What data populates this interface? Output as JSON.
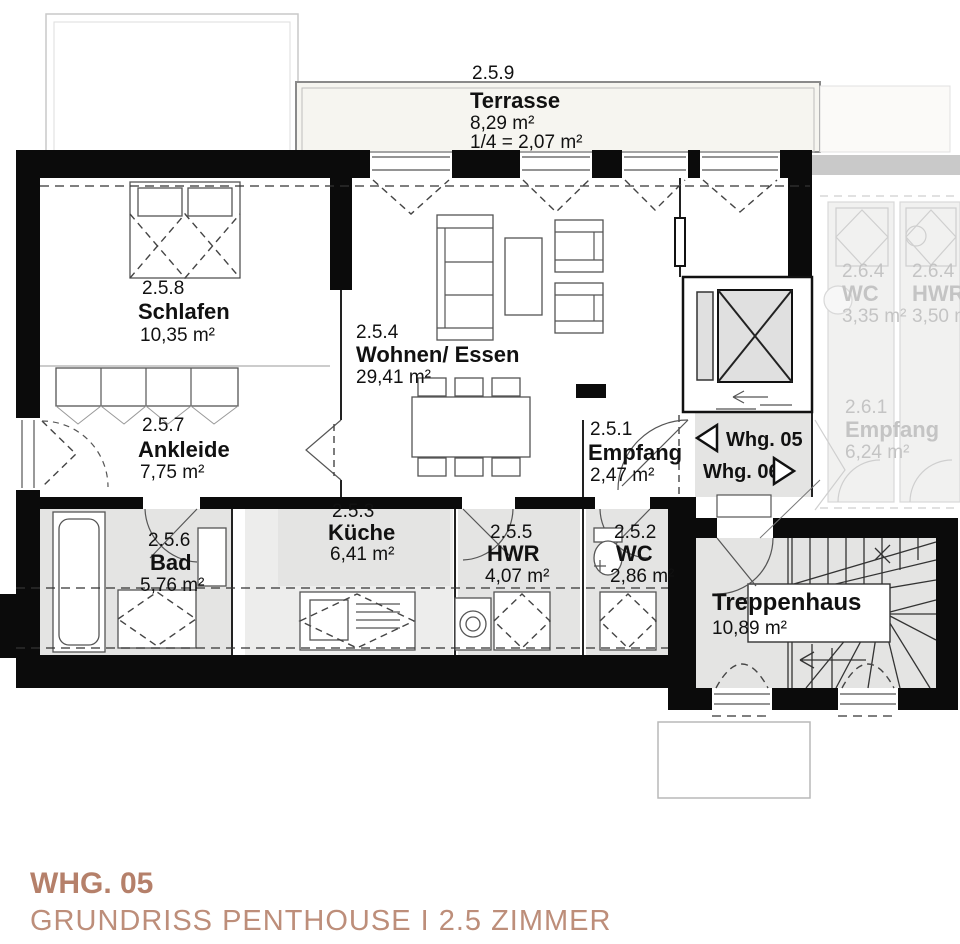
{
  "colors": {
    "wall": "#0b0b0b",
    "room_floor_gray": "#e4e4e3",
    "terrace_fill": "#f6f5f0",
    "neighbor_text": "#c4c4c4",
    "accent_title": "#b5806a",
    "accent_subtitle": "#bd8e7a"
  },
  "terrace": {
    "number": "2.5.9",
    "name": "Terrasse",
    "area": "8,29 m²",
    "share": "1/4 = 2,07 m²"
  },
  "rooms": [
    {
      "number": "2.5.8",
      "name": "Schlafen",
      "area": "10,35 m²"
    },
    {
      "number": "2.5.4",
      "name": "Wohnen/ Essen",
      "area": "29,41 m²"
    },
    {
      "number": "2.5.7",
      "name": "Ankleide",
      "area": "7,75 m²"
    },
    {
      "number": "2.5.1",
      "name": "Empfang",
      "area": "2,47 m²"
    },
    {
      "number": "2.5.6",
      "name": "Bad",
      "area": "5,76 m²"
    },
    {
      "number": "2.5.3",
      "name": "Küche",
      "area": "6,41 m²"
    },
    {
      "number": "2.5.5",
      "name": "HWR",
      "area": "4,07 m²"
    },
    {
      "number": "2.5.2",
      "name": "WC",
      "area": "2,86 m²"
    }
  ],
  "stairwell": {
    "name": "Treppenhaus",
    "area": "10,89 m²"
  },
  "neighbor_rooms": [
    {
      "number": "2.6.4",
      "name": "WC",
      "area": "3,35 m²"
    },
    {
      "number": "2.6.4",
      "name": "HWR",
      "area": "3,50 m²"
    },
    {
      "number": "2.6.1",
      "name": "Empfang",
      "area": "6,24 m²"
    }
  ],
  "corridor": {
    "whg05": "Whg. 05",
    "whg06": "Whg. 06"
  },
  "footer": {
    "title": "WHG. 05",
    "subtitle": "GRUNDRISS PENTHOUSE I 2.5 ZIMMER"
  }
}
